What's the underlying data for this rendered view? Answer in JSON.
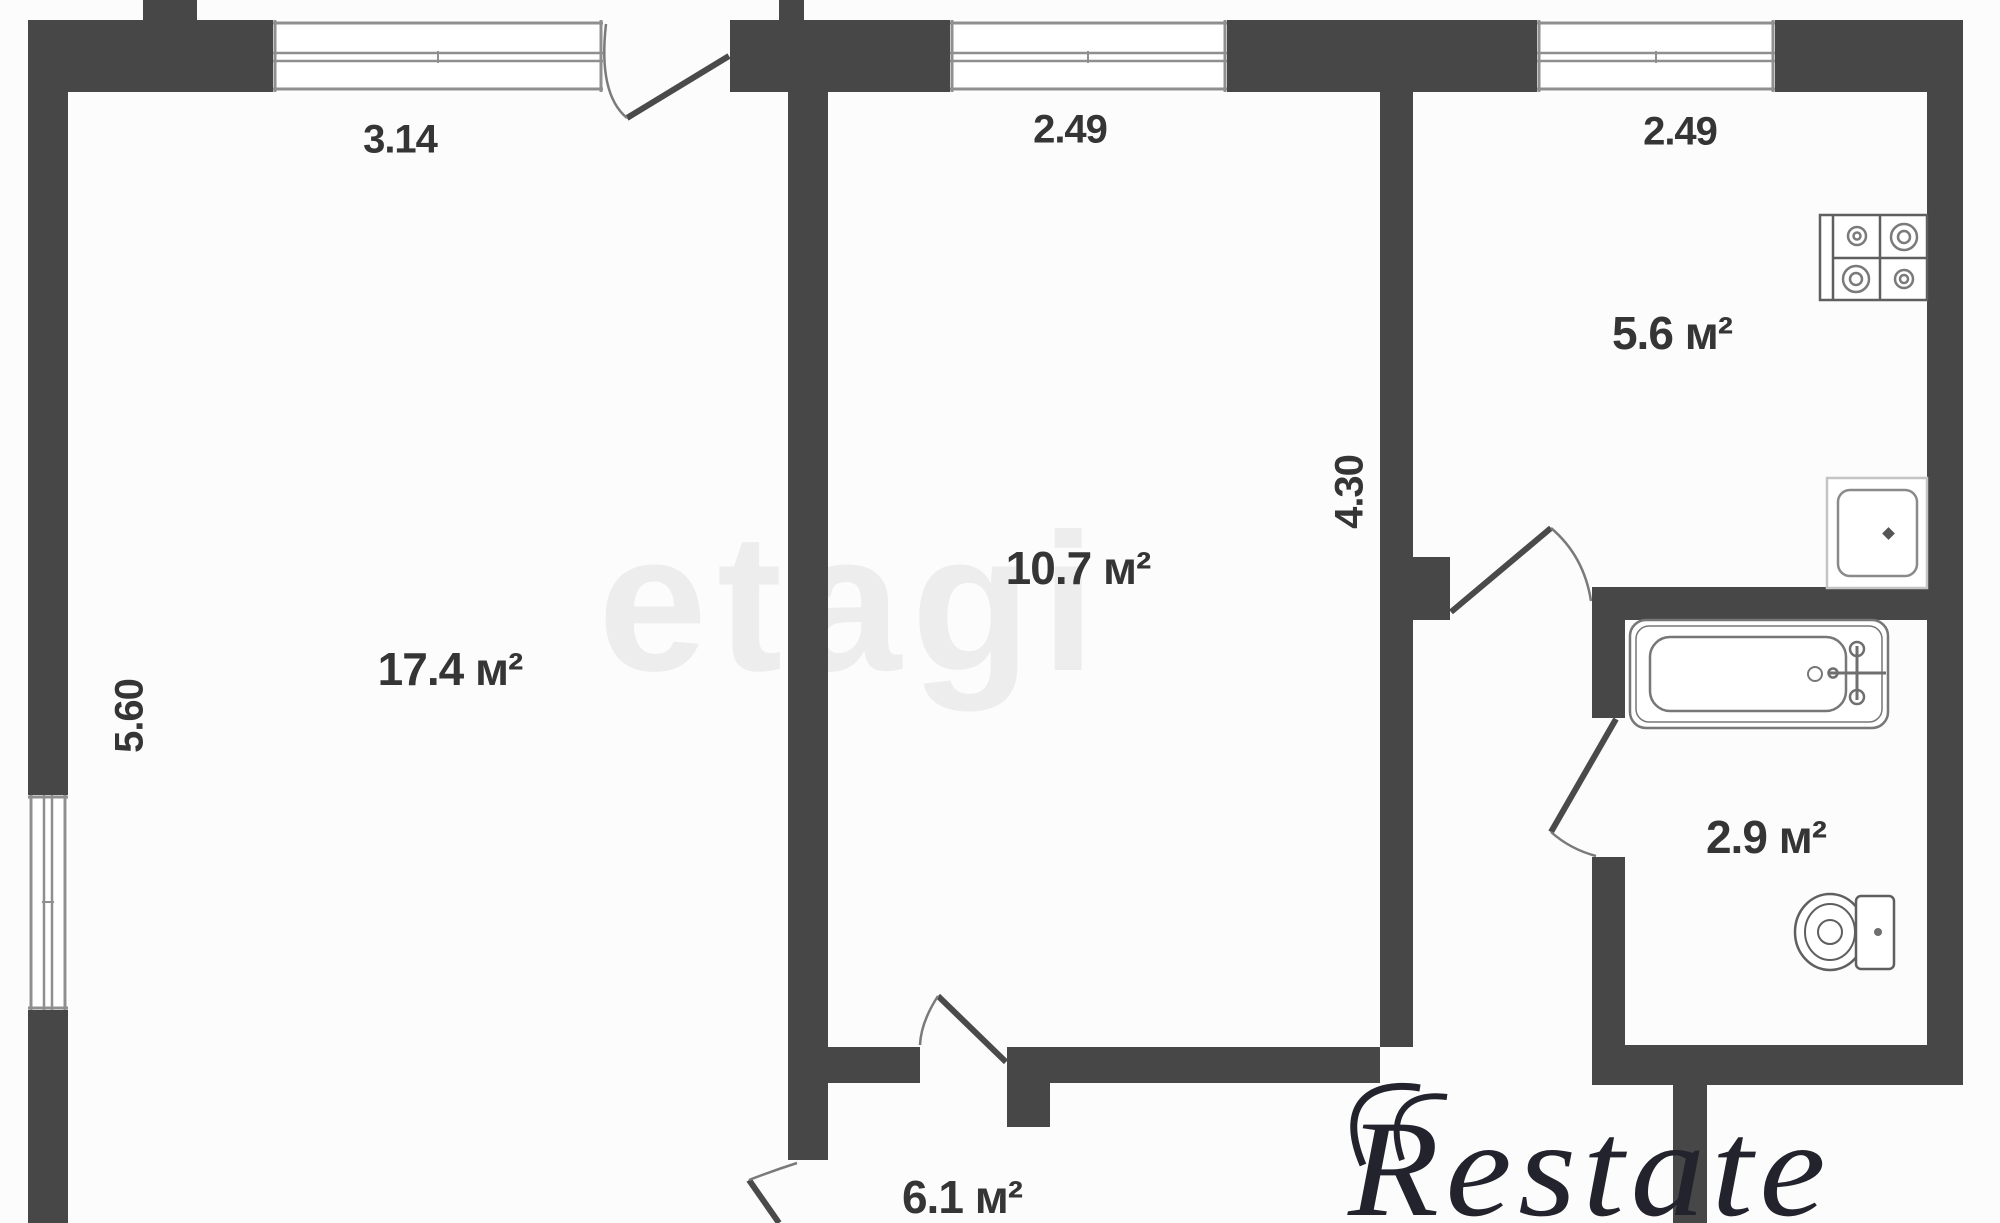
{
  "watermarks": {
    "center": "etagi",
    "corner": "Restate"
  },
  "rooms": [
    {
      "name": "living-room",
      "area_label": "17.4 м²"
    },
    {
      "name": "bedroom",
      "area_label": "10.7 м²"
    },
    {
      "name": "kitchen",
      "area_label": "5.6 м²"
    },
    {
      "name": "bathroom",
      "area_label": "2.9 м²"
    },
    {
      "name": "hallway",
      "area_label": "6.1 м²"
    }
  ],
  "dimensions": [
    {
      "name": "living-room-width",
      "label": "3.14"
    },
    {
      "name": "bedroom-width",
      "label": "2.49"
    },
    {
      "name": "kitchen-width",
      "label": "2.49"
    },
    {
      "name": "living-room-depth",
      "label": "5.60"
    },
    {
      "name": "bedroom-depth",
      "label": "4.30"
    }
  ],
  "fixtures": [
    {
      "name": "stove"
    },
    {
      "name": "kitchen-sink"
    },
    {
      "name": "bathtub"
    },
    {
      "name": "toilet"
    }
  ],
  "colors": {
    "wall": "#474747",
    "window_line": "#8f8f8f",
    "fixture_line": "#6f6f6f",
    "door_leaf": "#4a4a4a",
    "label_text": "#353535",
    "watermark_center": "#ededed",
    "watermark_corner": "#23232e"
  }
}
